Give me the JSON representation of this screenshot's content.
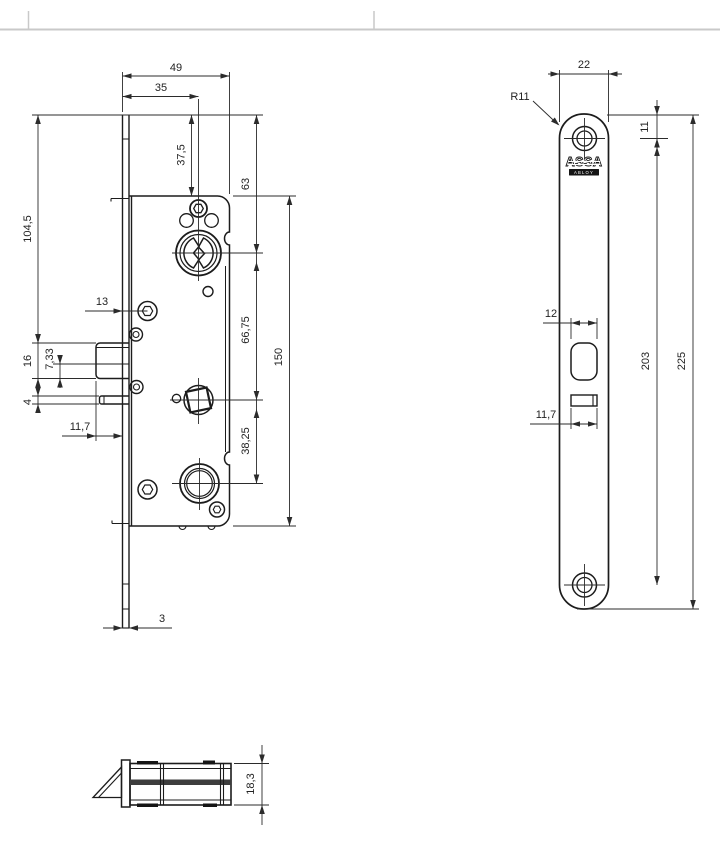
{
  "drawing": {
    "type": "technical drawing - mortise lock (three views with dimensions)",
    "colors": {
      "line": "#1c1c1c",
      "dimension": "#2b2b2b",
      "page_rule": "#c9c9c9",
      "band": "#3d3d3d"
    },
    "side_view": {
      "dims": {
        "d49": "49",
        "d35": "35",
        "d37_5": "37,5",
        "d63": "63",
        "d104_5": "104,5",
        "d13": "13",
        "d16": "16",
        "d7_33": "7,33",
        "d4": "4",
        "d11_7": "11,7",
        "d66_75": "66,75",
        "d150": "150",
        "d38_25": "38,25",
        "d3": "3"
      }
    },
    "front_view": {
      "dims": {
        "d22": "22",
        "dR11": "R11",
        "d11": "11",
        "d12": "12",
        "d11_7": "11,7",
        "d203": "203",
        "d225": "225"
      },
      "logo": {
        "line1": "ASSA",
        "line2": "ABLOY"
      }
    },
    "top_view": {
      "dims": {
        "d18_3": "18,3"
      }
    }
  }
}
